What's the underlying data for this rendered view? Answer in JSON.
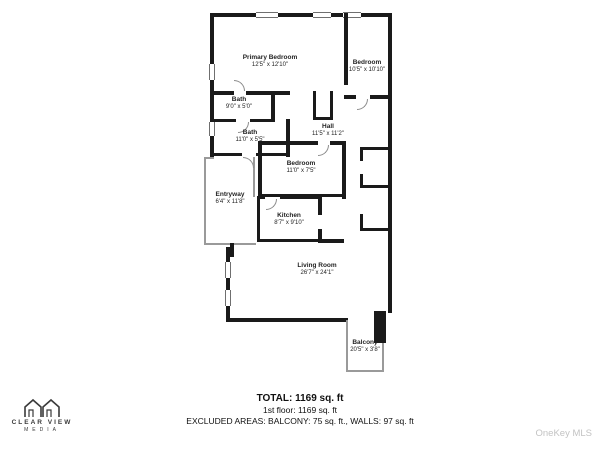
{
  "page": {
    "background": "#ffffff"
  },
  "colors": {
    "wall": "#1a1a1a",
    "label": "#1f1f1f",
    "watermark": "#c3c3c3"
  },
  "floorplan": {
    "rooms": [
      {
        "id": "primary-bedroom",
        "name": "Primary Bedroom",
        "dims": "12'5\" x 12'10\""
      },
      {
        "id": "bedroom-top-right",
        "name": "Bedroom",
        "dims": "10'5\" x 10'10\""
      },
      {
        "id": "bath-upper",
        "name": "Bath",
        "dims": "9'0\" x 5'0\""
      },
      {
        "id": "bath-lower",
        "name": "Bath",
        "dims": "11'0\" x 5'5\""
      },
      {
        "id": "hall",
        "name": "Hall",
        "dims": "11'5\" x 11'2\""
      },
      {
        "id": "bedroom-middle",
        "name": "Bedroom",
        "dims": "11'0\" x 7'5\""
      },
      {
        "id": "kitchen",
        "name": "Kitchen",
        "dims": "8'7\" x 9'10\""
      },
      {
        "id": "entryway",
        "name": "Entryway",
        "dims": "6'4\" x 11'8\""
      },
      {
        "id": "living-room",
        "name": "Living Room",
        "dims": "26'7\" x 24'1\""
      },
      {
        "id": "balcony",
        "name": "Balcony",
        "dims": "20'5\" x 3'8\""
      }
    ]
  },
  "footer": {
    "total": "TOTAL: 1169 sq. ft",
    "first_floor": "1st floor: 1169 sq. ft",
    "excluded": "EXCLUDED AREAS: BALCONY: 75 sq. ft., WALLS: 97 sq. ft"
  },
  "branding": {
    "logo_line1": "CLEAR VIEW",
    "logo_line2": "MEDIA",
    "watermark": "OneKey MLS"
  }
}
